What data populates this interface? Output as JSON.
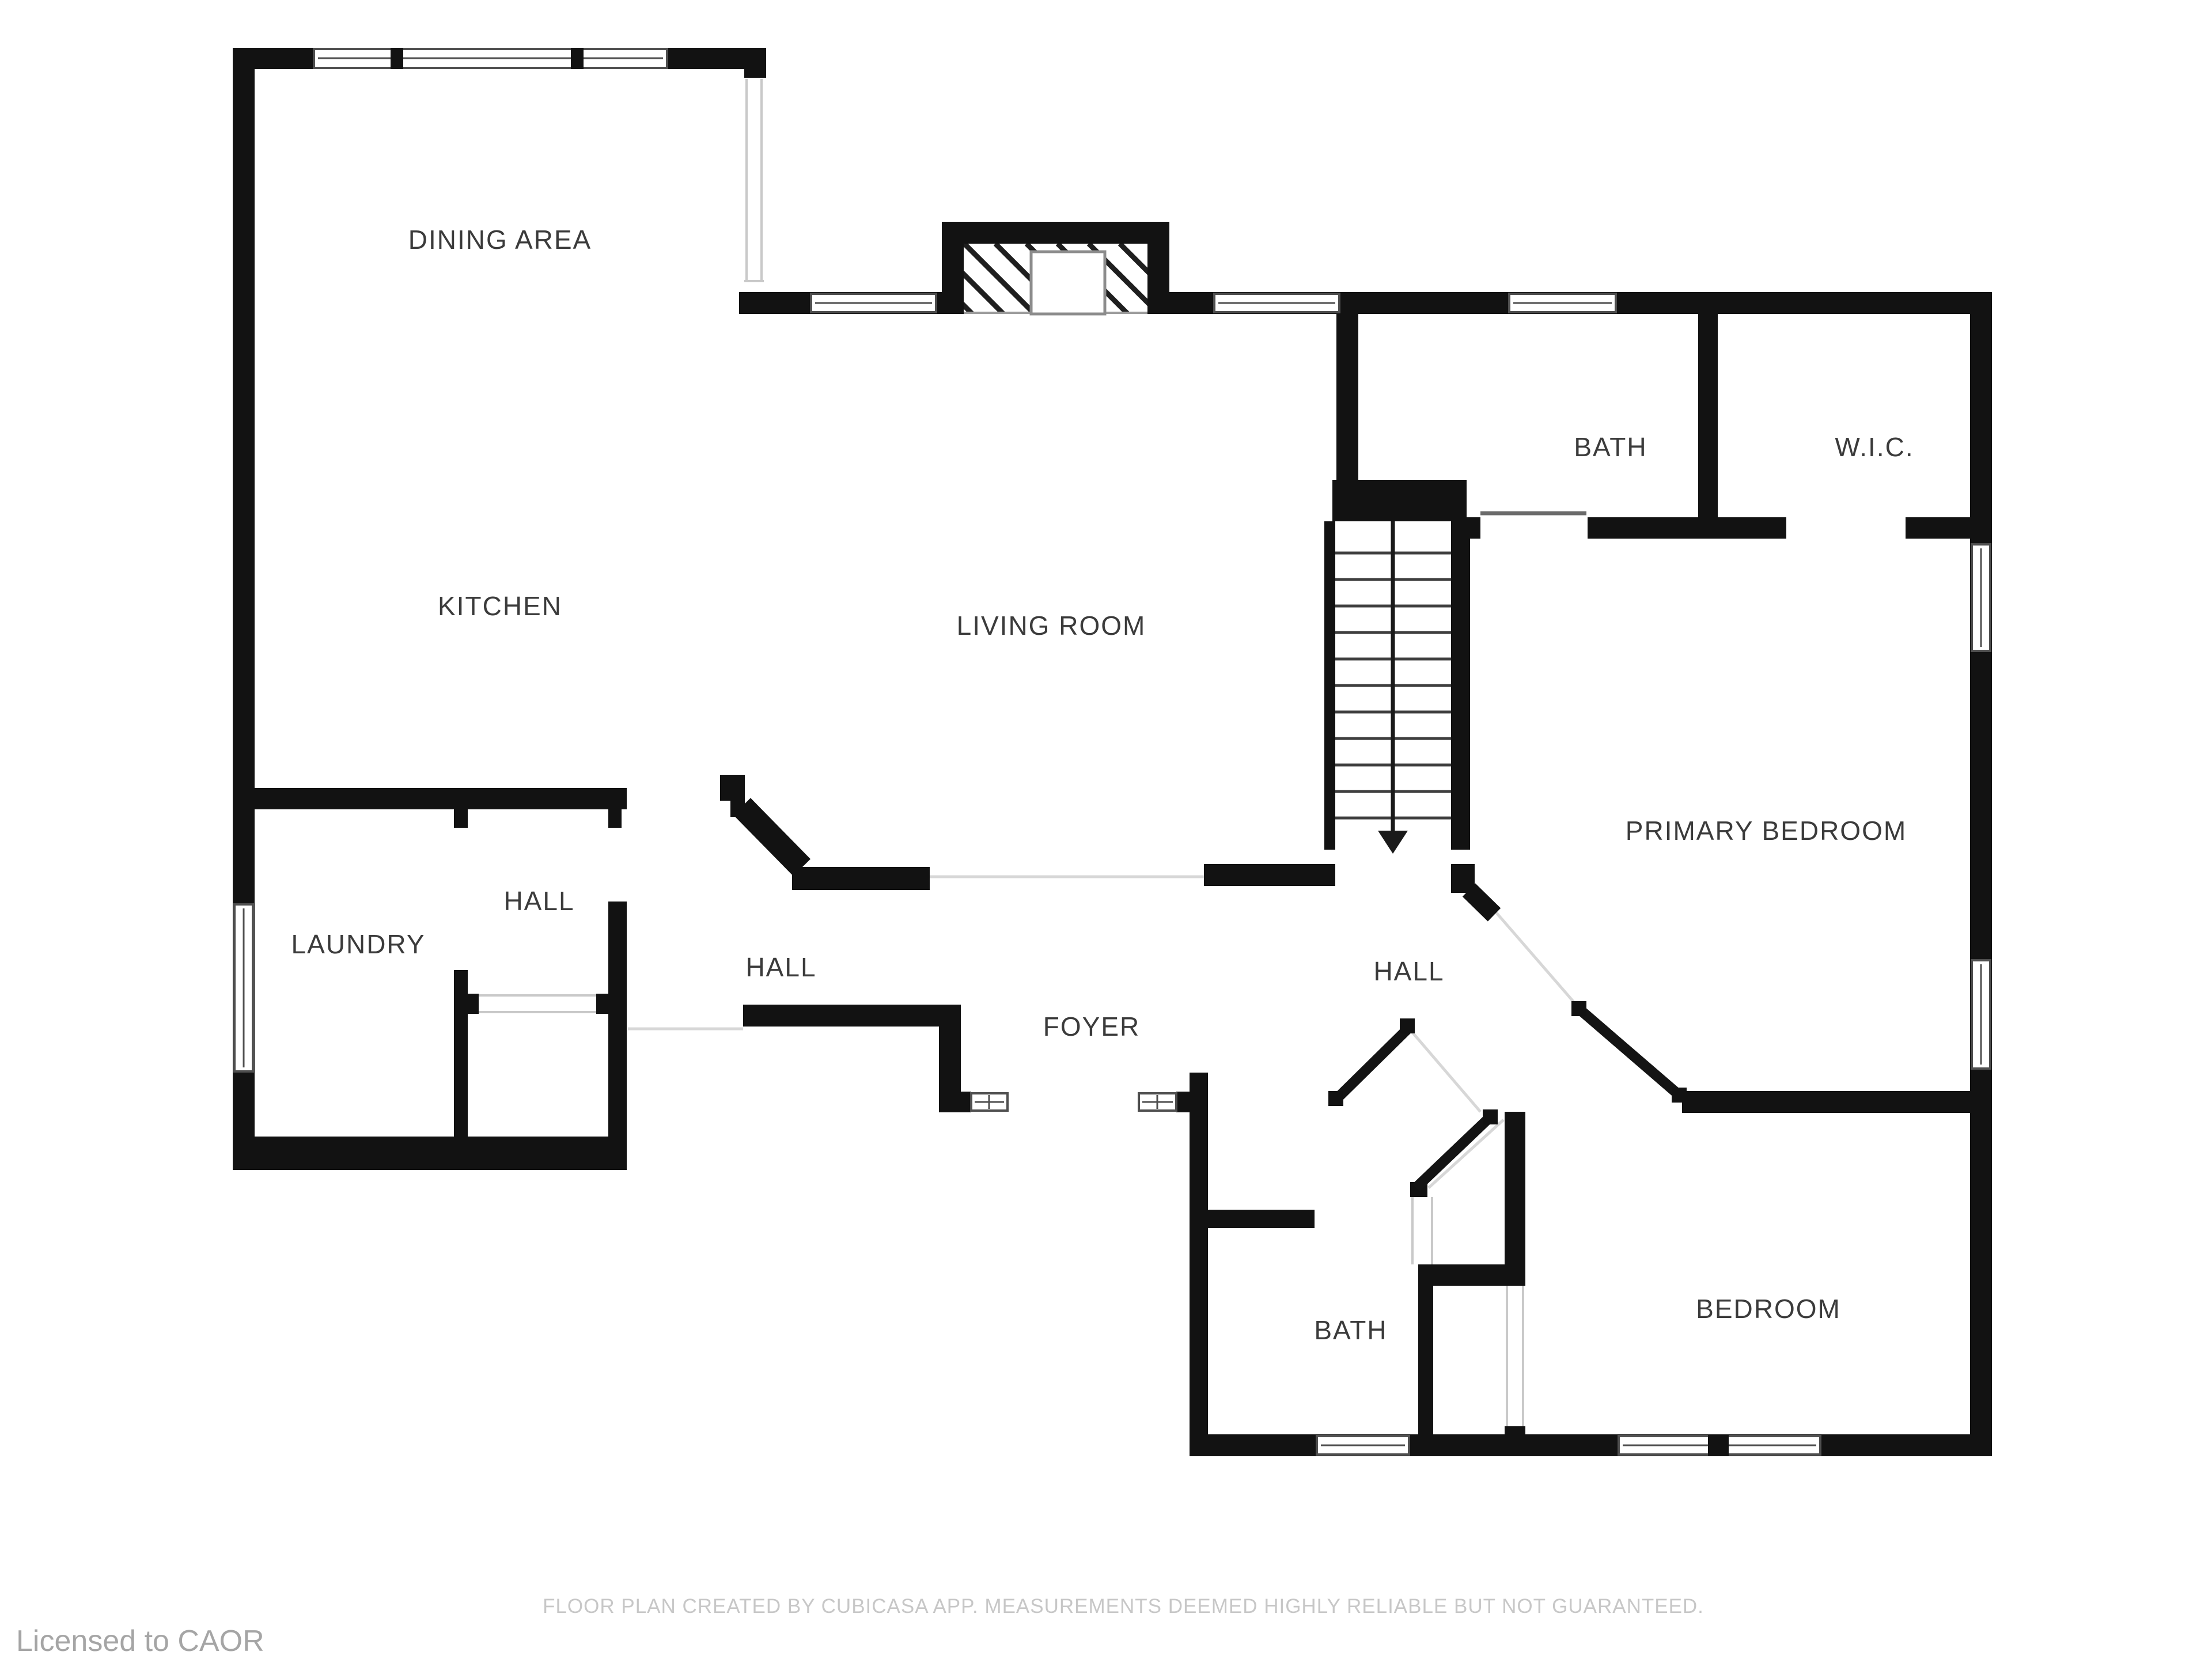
{
  "rooms": {
    "dining": "DINING AREA",
    "kitchen": "KITCHEN",
    "living": "LIVING ROOM",
    "bath_upper": "BATH",
    "wic": "W.I.C.",
    "primary_bedroom": "PRIMARY BEDROOM",
    "laundry": "LAUNDRY",
    "hall_small": "HALL",
    "hall_main": "HALL",
    "hall_east": "HALL",
    "foyer": "FOYER",
    "bath_lower": "BATH",
    "bedroom": "BEDROOM"
  },
  "footer": {
    "disclaimer": "FLOOR PLAN CREATED BY CUBICASA APP. MEASUREMENTS DEEMED HIGHLY RELIABLE BUT NOT GUARANTEED."
  },
  "license": {
    "text": "Licensed to CAOR"
  },
  "colors": {
    "background": "#ffffff",
    "wall": "#121212",
    "window_line": "#4f4f4f",
    "tread_line": "#3f3f3f",
    "faint_line": "#d7d7d7",
    "label_text": "#3b3b3b",
    "footer_text": "#c7c7c7",
    "license_text": "#a5a5a5"
  }
}
